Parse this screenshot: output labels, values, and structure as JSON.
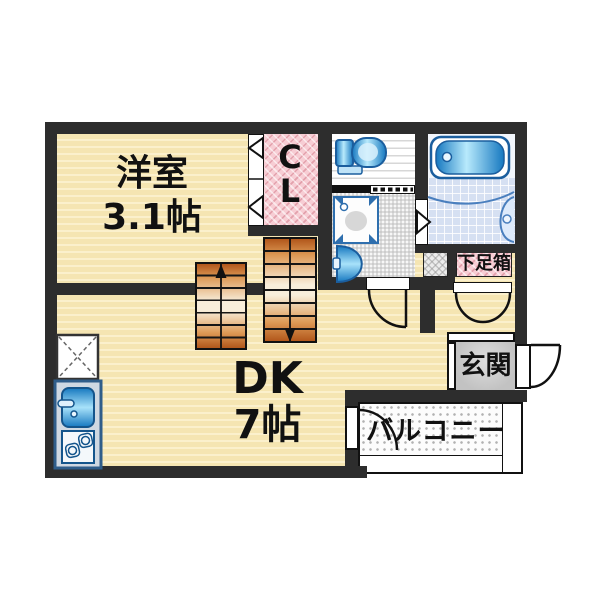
{
  "floorplan": {
    "rooms": {
      "western_room": {
        "name": "洋室",
        "size": "3.1帖"
      },
      "closet": {
        "line1": "C",
        "line2": "L"
      },
      "dining_kitchen": {
        "name": "DK",
        "size": "7帖"
      },
      "shoe_box": {
        "label": "下足箱"
      },
      "entrance": {
        "label": "玄関"
      },
      "balcony": {
        "label": "バルコニー"
      }
    },
    "fixtures": [
      "toilet",
      "bathtub",
      "bath-counter",
      "washing-machine-pan",
      "washbasin",
      "refrigerator-space",
      "kitchen-sink",
      "stove",
      "stairs-up",
      "stairs-down"
    ],
    "doors": [
      "closet-bifold-door",
      "washroom-door",
      "bathroom-door",
      "shoebox-double-door",
      "front-door",
      "balcony-door"
    ],
    "colors": {
      "wall": "#2d2d2d",
      "floor_cream": "#f5e5b2",
      "closet_pink": "#f7cdd4",
      "stairs_orange": "#b2571b",
      "fixture_blue": "#1678c0",
      "bath_tile": "#d6e0f2",
      "entrance_gray": "#c6c6c6"
    }
  }
}
